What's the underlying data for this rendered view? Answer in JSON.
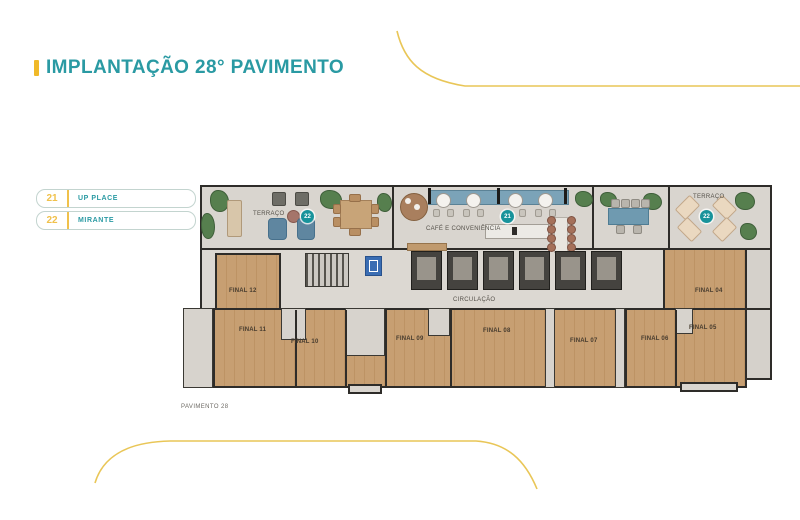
{
  "header": {
    "title": "IMPLANTAÇÃO 28° PAVIMENTO"
  },
  "legend": {
    "items": [
      {
        "number": "21",
        "label": "UP PLACE"
      },
      {
        "number": "22",
        "label": "MIRANTE"
      }
    ]
  },
  "plan": {
    "caption": "PAVIMENTO 28",
    "areas": {
      "terrace_left": "TERRAÇO",
      "cafe": "CAFÉ E CONVENIÊNCIA",
      "terrace_right": "TERRAÇO",
      "circulation": "CIRCULAÇÃO"
    },
    "badges": [
      {
        "area": "terrace-left",
        "number": "22"
      },
      {
        "area": "cafe",
        "number": "21"
      },
      {
        "area": "terrace-right",
        "number": "22"
      }
    ],
    "units": [
      {
        "label": "FINAL 12"
      },
      {
        "label": "FINAL 04"
      },
      {
        "label": "FINAL 11"
      },
      {
        "label": "FINAL 10"
      },
      {
        "label": "FINAL 09"
      },
      {
        "label": "FINAL 08"
      },
      {
        "label": "FINAL 07"
      },
      {
        "label": "FINAL 06"
      },
      {
        "label": "FINAL 05"
      }
    ]
  },
  "colors": {
    "title_teal": "#2a9aa3",
    "accent_yellow": "#f0b929",
    "curve_yellow": "#e9c657",
    "badge_teal": "#18939b"
  }
}
